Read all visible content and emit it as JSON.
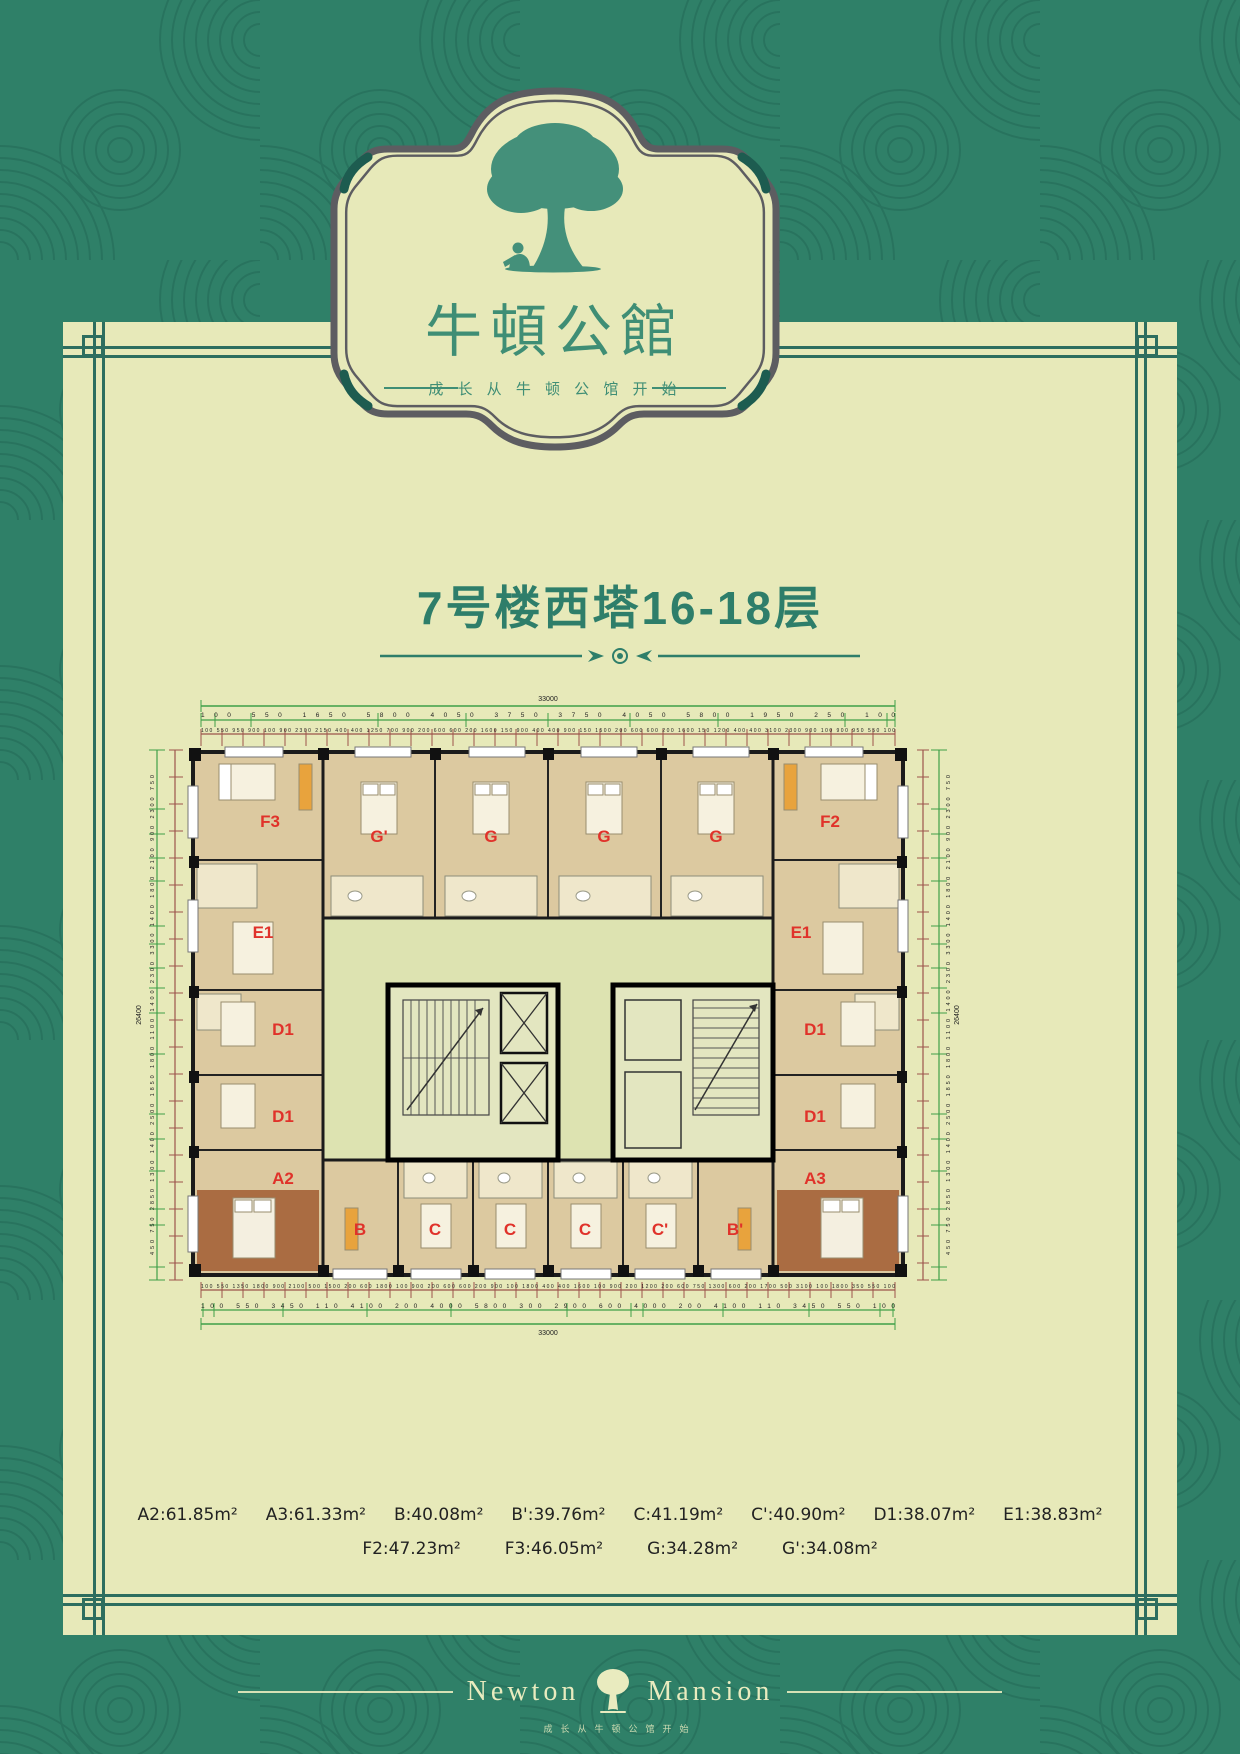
{
  "brand": {
    "logo_title": "牛頓公館",
    "logo_tagline": "成 长 从 牛 顿 公 馆 开 始",
    "tree_icon": "tree-with-reading-child-icon"
  },
  "page_title": "7号楼西塔16-18层",
  "plan": {
    "units": [
      {
        "label": "F3"
      },
      {
        "label": "G'"
      },
      {
        "label": "G"
      },
      {
        "label": "G"
      },
      {
        "label": "G"
      },
      {
        "label": "F2"
      },
      {
        "label": "E1"
      },
      {
        "label": "E1"
      },
      {
        "label": "D1"
      },
      {
        "label": "D1"
      },
      {
        "label": "D1"
      },
      {
        "label": "D1"
      },
      {
        "label": "A2"
      },
      {
        "label": "A3"
      },
      {
        "label": "B"
      },
      {
        "label": "C"
      },
      {
        "label": "C"
      },
      {
        "label": "C"
      },
      {
        "label": "C'"
      },
      {
        "label": "B'"
      }
    ],
    "dimensions": {
      "top_total": "33000",
      "top_segments": "100 550 1650 5800 4050 3750 3750 4050 5800 1950 250 100",
      "top_detail": "100 550 950 900 100 900 2300 2150 400 400 1250 700 900 200 600 600 200 1600 150 900 400 400 900 150 1500 200 600 600 200 1600 150 1200 400 400 3100 2300 900 100 900 950 550 100",
      "bottom_detail": "100 550 1350 1800 900 2100 500 1500 200 600 1800 100 900 200 600 600 200 900 100 1800 400 400 1600 100 900 200 1200 200 600 750 1300 600 200 1700 500 3100 100 1800 350 550 100",
      "bottom_segments": "100 550 3450 110 4100 200 4000 5800 300 2900 600 4000 200 4100 110 3450 550 100",
      "bottom_total": "33000",
      "left_total": "26400",
      "left_segments": "450 750 2850 1300 1400 2500 1850 1800 1100 1400 2300 3300 1400 1800 2100 900 2300 750",
      "right_total": "26400",
      "right_segments": "450 750 2850 1300 1400 2500 1850 1800 1100 1400 2300 3300 1400 1800 2100 900 2300 750"
    }
  },
  "legend": {
    "line1": [
      "A2:61.85m²",
      "A3:61.33m²",
      "B:40.08m²",
      "B':39.76m²",
      "C:41.19m²",
      "C':40.90m²",
      "D1:38.07m²",
      "E1:38.83m²"
    ],
    "line2": [
      "F2:47.23m²",
      "F3:46.05m²",
      "G:34.28m²",
      "G':34.08m²"
    ]
  },
  "footer": {
    "name_left": "Newton",
    "name_right": "Mansion",
    "tagline": "成长从牛顿公馆开始"
  },
  "colors": {
    "background_green": "#2f8068",
    "leaf_line_green": "#28735e",
    "panel_cream": "#e7e9b9",
    "frame_teal": "#2d6e5f",
    "badge_border_gray": "#5d5d61",
    "logo_green": "#3f8e75",
    "title_green": "#2e7e6a",
    "unit_label_red": "#e0322a",
    "wall_black": "#1b1b1b",
    "floor_wood": "#dcc9a0",
    "floor_tile": "#efe7cb",
    "corridor_green": "#dde3b1",
    "bedroom_brown": "#aa6c42",
    "dim_green": "#3fa048",
    "dim_red": "#9c544c",
    "footer_cream": "#e9ebbf"
  }
}
